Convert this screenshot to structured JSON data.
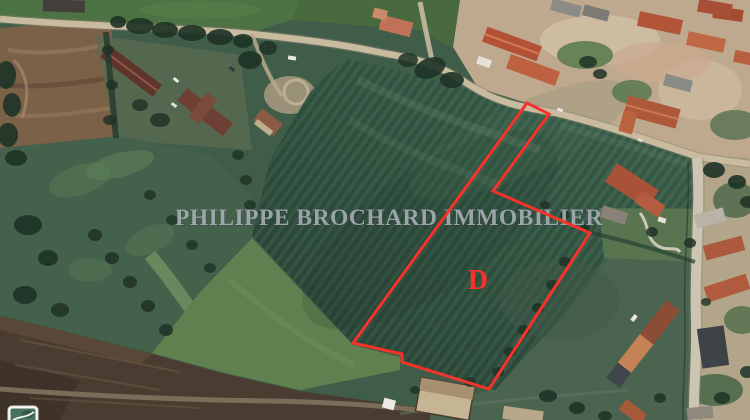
{
  "watermark": {
    "text": "PHILIPPE BROCHARD IMMOBILIER",
    "color": "#aab0b8"
  },
  "parcel": {
    "label": "D",
    "outline_color": "#f5332b",
    "outline_points": "527,103 549,114 493,191 590,233 489,389 402,362 402,354 353,343"
  },
  "map": {
    "view_type": "satellite-aerial",
    "minimap_icon": "map-thumbnail"
  }
}
